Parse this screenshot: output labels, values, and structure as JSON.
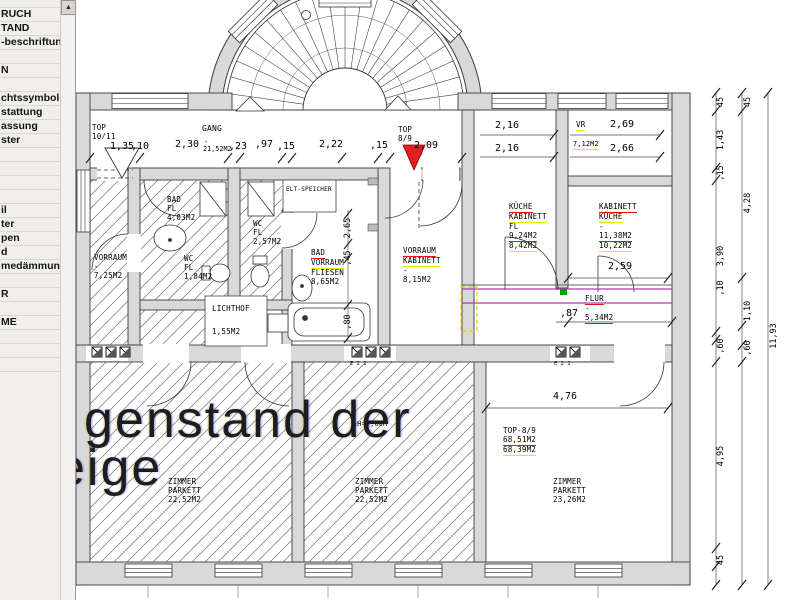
{
  "sidebar": {
    "items": [
      "RUCH",
      "TAND",
      "-beschriftung",
      "",
      "N",
      "",
      "chtssymbole",
      "stattung",
      "assung",
      "ster",
      "",
      "",
      "",
      "",
      "il",
      "ter",
      "pen",
      "d",
      "medämmung",
      "",
      "R",
      "",
      "ME",
      "",
      "",
      ""
    ]
  },
  "scrollbar": {
    "up_glyph": "▲"
  },
  "watermark": {
    "line1": "genstand der",
    "line2": "eige"
  },
  "colors": {
    "red_underline": "#e21414",
    "yellow_underline": "#efe400",
    "entry_marker_red": "#e02020",
    "wall_fill": "#d9d9d9",
    "flur_magenta": "#b23ab2",
    "flur_green": "#00a000",
    "highlight_yellow": "#e6d800"
  },
  "plan": {
    "room_labels": [
      {
        "x": 92,
        "y": 124,
        "lines": [
          {
            "t": "TOP"
          },
          {
            "t": "10/11"
          }
        ]
      },
      {
        "x": 202,
        "y": 125,
        "cls": "mid",
        "lines": [
          {
            "t": "GANG"
          }
        ]
      },
      {
        "x": 398,
        "y": 126,
        "lines": [
          {
            "t": "TOP"
          },
          {
            "t": "8/9"
          }
        ]
      },
      {
        "x": 576,
        "y": 121,
        "lines": [
          {
            "t": "VR",
            "u": "yellow"
          }
        ]
      },
      {
        "x": 573,
        "y": 140,
        "cls": "small",
        "lines": [
          {
            "t": "7,12M2",
            "u": "yellow"
          }
        ]
      },
      {
        "x": 167,
        "y": 196,
        "lines": [
          {
            "t": "BAD"
          },
          {
            "t": "FL"
          },
          {
            "t": "4,03M2"
          }
        ]
      },
      {
        "x": 253,
        "y": 220,
        "lines": [
          {
            "t": "WC"
          },
          {
            "t": "FL"
          },
          {
            "t": "2,57M2"
          }
        ]
      },
      {
        "x": 184,
        "y": 255,
        "lines": [
          {
            "t": "WC"
          },
          {
            "t": "FL"
          },
          {
            "t": "1,84M2"
          }
        ]
      },
      {
        "x": 94,
        "y": 254,
        "lines": [
          {
            "t": "VORRAUM"
          },
          {
            "t": "-"
          },
          {
            "t": "7,25M2"
          }
        ]
      },
      {
        "x": 311,
        "y": 249,
        "lines": [
          {
            "t": "BAD",
            "u": "red"
          },
          {
            "t": "VORRAUM",
            "u": "yellow"
          },
          {
            "t": "FLIESEN"
          },
          {
            "t": "8,65M2"
          }
        ]
      },
      {
        "x": 403,
        "y": 247,
        "lines": [
          {
            "t": "VORRAUM",
            "u": "red"
          },
          {
            "t": "KABINETT",
            "u": "yellow"
          },
          {
            "t": "-"
          },
          {
            "t": "8,15M2"
          }
        ]
      },
      {
        "x": 509,
        "y": 203,
        "lines": [
          {
            "t": "KÜCHE",
            "u": "red"
          },
          {
            "t": "KABINETT",
            "u": "yellow"
          },
          {
            "t": "FL"
          },
          {
            "t": "9,24M2",
            "u": "red"
          },
          {
            "t": "8,42M2",
            "u": "yellow"
          }
        ]
      },
      {
        "x": 599,
        "y": 203,
        "lines": [
          {
            "t": "KABINETT",
            "u": "red"
          },
          {
            "t": "KÜCHE",
            "u": "yellow"
          },
          {
            "t": "-"
          },
          {
            "t": "11,38M2",
            "u": "red"
          },
          {
            "t": "10,22M2",
            "u": "yellow"
          }
        ]
      },
      {
        "x": 286,
        "y": 186,
        "cls": "tiny",
        "lines": [
          {
            "t": "ELT-SPEICHER"
          }
        ]
      },
      {
        "x": 212,
        "y": 305,
        "lines": [
          {
            "t": "LICHTHOF"
          }
        ]
      },
      {
        "x": 212,
        "y": 328,
        "lines": [
          {
            "t": "1,55M2"
          }
        ]
      },
      {
        "x": 585,
        "y": 295,
        "lines": [
          {
            "t": "FLUR",
            "u": "red"
          },
          {
            "t": "-"
          },
          {
            "t": "5,34M2",
            "u": "red"
          }
        ]
      },
      {
        "x": 503,
        "y": 427,
        "lines": [
          {
            "t": "TOP-8/9"
          },
          {
            "t": "68,51M2",
            "u": "red"
          },
          {
            "t": "68,39M2",
            "u": "yellow"
          }
        ]
      },
      {
        "x": 168,
        "y": 478,
        "lines": [
          {
            "t": "ZIMMER"
          },
          {
            "t": "PARKETT"
          },
          {
            "t": "22,52M2"
          }
        ]
      },
      {
        "x": 355,
        "y": 478,
        "lines": [
          {
            "t": "ZIMMER"
          },
          {
            "t": "PARKETT"
          },
          {
            "t": "22,52M2"
          }
        ]
      },
      {
        "x": 553,
        "y": 478,
        "lines": [
          {
            "t": "ZIMMER"
          },
          {
            "t": "PARKETT"
          },
          {
            "t": "23,26M2"
          }
        ]
      },
      {
        "x": 353,
        "y": 420,
        "cls": "small",
        "lines": [
          {
            "t": "LH=3,00M"
          }
        ]
      }
    ],
    "dims": [
      {
        "x": 59,
        "y": 141,
        "t": "5"
      },
      {
        "x": 110,
        "y": 141,
        "t": "1,35"
      },
      {
        "x": 131,
        "y": 141,
        "t": ",10"
      },
      {
        "x": 175,
        "y": 139,
        "t": "2,30"
      },
      {
        "x": 204,
        "y": 138,
        "t": "-",
        "cls": "area"
      },
      {
        "x": 203,
        "y": 145,
        "t": "21,52M2",
        "cls": "area"
      },
      {
        "x": 229,
        "y": 141,
        "t": ",23"
      },
      {
        "x": 255,
        "y": 139,
        "t": ",97"
      },
      {
        "x": 277,
        "y": 141,
        "t": ",15"
      },
      {
        "x": 319,
        "y": 139,
        "t": "2,22"
      },
      {
        "x": 370,
        "y": 140,
        "t": ",15"
      },
      {
        "x": 414,
        "y": 140,
        "t": "2,09"
      },
      {
        "x": 495,
        "y": 120,
        "t": "2,16"
      },
      {
        "x": 495,
        "y": 143,
        "t": "2,16"
      },
      {
        "x": 610,
        "y": 119,
        "t": "2,69"
      },
      {
        "x": 610,
        "y": 143,
        "t": "2,66"
      },
      {
        "x": 608,
        "y": 261,
        "t": "2,59"
      },
      {
        "x": 560,
        "y": 308,
        "t": ",87"
      },
      {
        "x": 553,
        "y": 391,
        "t": "4,76"
      },
      {
        "x": 348,
        "y": 228,
        "t": "2,65",
        "rot": 1,
        "cls": "dim-v"
      },
      {
        "x": 348,
        "y": 258,
        "t": ",45",
        "rot": 1,
        "cls": "dim-v"
      },
      {
        "x": 348,
        "y": 322,
        "t": ",80",
        "rot": 1,
        "cls": "dim-v"
      },
      {
        "x": 721,
        "y": 102,
        "t": "45",
        "rot": 1,
        "cls": "dim-v"
      },
      {
        "x": 721,
        "y": 140,
        "t": "1,43",
        "rot": 1,
        "cls": "dim-v"
      },
      {
        "x": 721,
        "y": 173,
        "t": ",15",
        "rot": 1,
        "cls": "dim-v"
      },
      {
        "x": 721,
        "y": 256,
        "t": "3,90",
        "rot": 1,
        "cls": "dim-v"
      },
      {
        "x": 721,
        "y": 288,
        "t": ",10",
        "rot": 1,
        "cls": "dim-v"
      },
      {
        "x": 721,
        "y": 346,
        "t": ",60",
        "rot": 1,
        "cls": "dim-v"
      },
      {
        "x": 721,
        "y": 456,
        "t": "4,95",
        "rot": 1,
        "cls": "dim-v"
      },
      {
        "x": 721,
        "y": 560,
        "t": "45",
        "rot": 1,
        "cls": "dim-v"
      },
      {
        "x": 748,
        "y": 102,
        "t": "45",
        "rot": 1,
        "cls": "dim-v"
      },
      {
        "x": 748,
        "y": 203,
        "t": "4,28",
        "rot": 1,
        "cls": "dim-v"
      },
      {
        "x": 748,
        "y": 311,
        "t": "1,10",
        "rot": 1,
        "cls": "dim-v"
      },
      {
        "x": 748,
        "y": 348,
        "t": ",60",
        "rot": 1,
        "cls": "dim-v"
      },
      {
        "x": 774,
        "y": 336,
        "t": "11,93",
        "rot": 1,
        "cls": "dim-v"
      },
      {
        "x": 350,
        "y": 361,
        "t": "E 2 1",
        "cls": "tinytxt"
      },
      {
        "x": 554,
        "y": 361,
        "t": "E 2 1",
        "cls": "tinytxt"
      }
    ]
  }
}
